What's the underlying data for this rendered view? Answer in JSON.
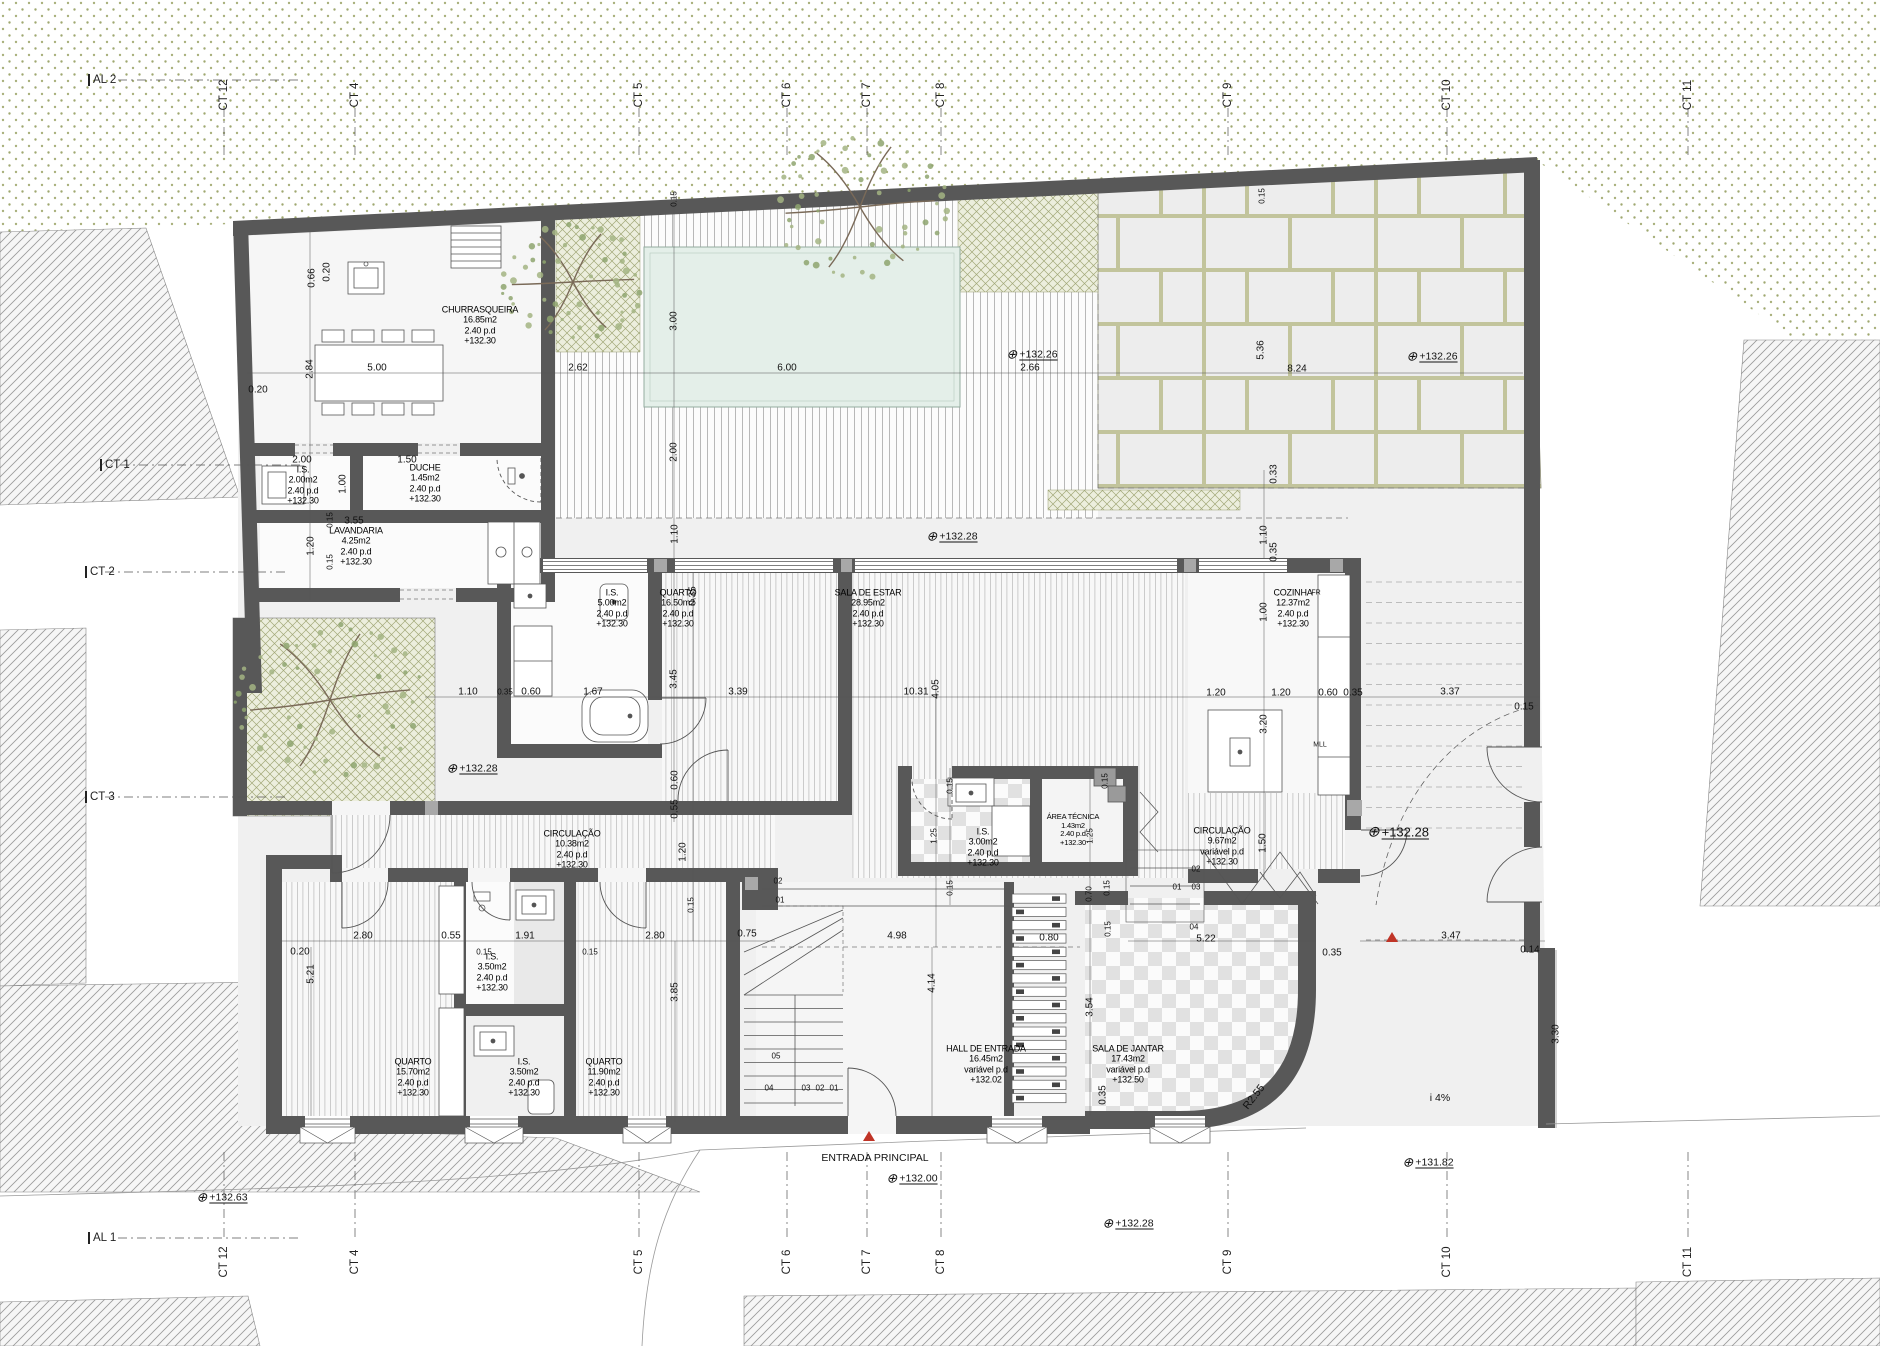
{
  "colors": {
    "wall": "#585858",
    "pool": "#e4efe9",
    "vegetation_dot": "#a9b07c",
    "planter": "#eceedd",
    "slab_joint": "#c2c49c",
    "accent_red": "#c03427"
  },
  "rooms": [
    {
      "name": "CHURRASQUEIRA",
      "area": "16.85m2",
      "pd": "2.40  p.d",
      "level": "+132.30",
      "x": 480,
      "y": 325
    },
    {
      "name": "I.S.",
      "area": "2.00m2",
      "pd": "2.40  p.d",
      "level": "+132.30",
      "x": 303,
      "y": 485
    },
    {
      "name": "DUCHE",
      "area": "1.45m2",
      "pd": "2.40  p.d",
      "level": "+132.30",
      "x": 425,
      "y": 483
    },
    {
      "name": "LAVANDARIA",
      "area": "4.25m2",
      "pd": "2.40  p.d",
      "level": "+132.30",
      "x": 356,
      "y": 546
    },
    {
      "name": "I.S.",
      "area": "5.00m2",
      "pd": "2.40  p.d",
      "level": "+132.30",
      "x": 612,
      "y": 608
    },
    {
      "name": "QUARTO",
      "area": "16.50m2",
      "pd": "2.40  p.d",
      "level": "+132.30",
      "x": 678,
      "y": 608
    },
    {
      "name": "SALA DE ESTAR",
      "area": "28.95m2",
      "pd": "2.40  p.d",
      "level": "+132.30",
      "x": 868,
      "y": 608
    },
    {
      "name": "COZINHA",
      "area": "12.37m2",
      "pd": "2.40  p.d",
      "level": "+132.30",
      "x": 1293,
      "y": 608
    },
    {
      "name": "I.S.",
      "area": "3.00m2",
      "pd": "2.40  p.d",
      "level": "+132.30",
      "x": 983,
      "y": 847
    },
    {
      "name": "ÁREA TÉCNICA",
      "area": "1.43m2",
      "pd": "2.40  p.d",
      "level": "+132.30",
      "x": 1073,
      "y": 830,
      "small": true
    },
    {
      "name": "CIRCULAÇÃO",
      "area": "9.67m2",
      "pd": "variável  p.d",
      "level": "+132.30",
      "x": 1222,
      "y": 846
    },
    {
      "name": "CIRCULAÇÃO",
      "area": "10.38m2",
      "pd": "2.40  p.d",
      "level": "+132.30",
      "x": 572,
      "y": 849
    },
    {
      "name": "HALL  DE  ENTRADA",
      "area": "16.45m2",
      "pd": "variável  p.d",
      "level": "+132.02",
      "x": 986,
      "y": 1064
    },
    {
      "name": "SALA  DE  JANTAR",
      "area": "17.43m2",
      "pd": "variável  p.d",
      "level": "+132.50",
      "x": 1128,
      "y": 1064
    },
    {
      "name": "QUARTO",
      "area": "15.70m2",
      "pd": "2.40  p.d",
      "level": "+132.30",
      "x": 413,
      "y": 1077
    },
    {
      "name": "I.S.",
      "area": "3.50m2",
      "pd": "2.40  p.d",
      "level": "+132.30",
      "x": 524,
      "y": 1077
    },
    {
      "name": "QUARTO",
      "area": "11.90m2",
      "pd": "2.40  p.d",
      "level": "+132.30",
      "x": 604,
      "y": 1077
    },
    {
      "name": "I.S.",
      "area": "3.50m2",
      "pd": "2.40  p.d",
      "level": "+132.30",
      "x": 492,
      "y": 972
    }
  ],
  "dims": [
    {
      "t": "0.66",
      "x": 312,
      "y": 278,
      "r": 1
    },
    {
      "t": "0.20",
      "x": 327,
      "y": 272,
      "r": 1
    },
    {
      "t": "2.84",
      "x": 310,
      "y": 369,
      "r": 1
    },
    {
      "t": "5.00",
      "x": 377,
      "y": 368
    },
    {
      "t": "2.62",
      "x": 578,
      "y": 368
    },
    {
      "t": "6.00",
      "x": 787,
      "y": 368
    },
    {
      "t": "2.66",
      "x": 1030,
      "y": 368
    },
    {
      "t": "8.24",
      "x": 1297,
      "y": 369
    },
    {
      "t": "5.36",
      "x": 1261,
      "y": 350,
      "r": 1
    },
    {
      "t": "3.00",
      "x": 674,
      "y": 321,
      "r": 1
    },
    {
      "t": "2.00",
      "x": 674,
      "y": 452,
      "r": 1
    },
    {
      "t": "0.15",
      "x": 674,
      "y": 199,
      "r": 1,
      "s": 1
    },
    {
      "t": "0.15",
      "x": 1262,
      "y": 196,
      "r": 1,
      "s": 1
    },
    {
      "t": "0.20",
      "x": 258,
      "y": 390
    },
    {
      "t": "2.00",
      "x": 302,
      "y": 460
    },
    {
      "t": "1.50",
      "x": 407,
      "y": 460
    },
    {
      "t": "1.00",
      "x": 343,
      "y": 484,
      "r": 1
    },
    {
      "t": "3.55",
      "x": 354,
      "y": 521
    },
    {
      "t": "0.15",
      "x": 330,
      "y": 520,
      "r": 1,
      "s": 1
    },
    {
      "t": "1.20",
      "x": 311,
      "y": 546,
      "r": 1
    },
    {
      "t": "0.15",
      "x": 330,
      "y": 562,
      "r": 1,
      "s": 1
    },
    {
      "t": "0.33",
      "x": 1274,
      "y": 474,
      "r": 1
    },
    {
      "t": "1.10",
      "x": 1264,
      "y": 535,
      "r": 1
    },
    {
      "t": "0.35",
      "x": 1274,
      "y": 552,
      "r": 1
    },
    {
      "t": "1.00",
      "x": 1264,
      "y": 612,
      "r": 1
    },
    {
      "t": "1.10",
      "x": 675,
      "y": 534,
      "r": 1
    },
    {
      "t": "3.45",
      "x": 674,
      "y": 679,
      "r": 1
    },
    {
      "t": "0.35",
      "x": 693,
      "y": 596,
      "r": 1
    },
    {
      "t": "0.60",
      "x": 675,
      "y": 780,
      "r": 1
    },
    {
      "t": "0.55",
      "x": 675,
      "y": 809,
      "r": 1
    },
    {
      "t": "1.20",
      "x": 683,
      "y": 852,
      "r": 1
    },
    {
      "t": "1.10",
      "x": 468,
      "y": 692
    },
    {
      "t": "0.35",
      "x": 505,
      "y": 692,
      "s": 1
    },
    {
      "t": "0.60",
      "x": 531,
      "y": 692
    },
    {
      "t": "1.67",
      "x": 593,
      "y": 692
    },
    {
      "t": "3.39",
      "x": 738,
      "y": 692
    },
    {
      "t": "10.31",
      "x": 916,
      "y": 692
    },
    {
      "t": "4.05",
      "x": 936,
      "y": 689,
      "r": 1
    },
    {
      "t": "1.20",
      "x": 1216,
      "y": 693
    },
    {
      "t": "1.20",
      "x": 1281,
      "y": 693
    },
    {
      "t": "0.60",
      "x": 1328,
      "y": 693
    },
    {
      "t": "0.35",
      "x": 1353,
      "y": 693
    },
    {
      "t": "3.37",
      "x": 1450,
      "y": 692
    },
    {
      "t": "0.15",
      "x": 1524,
      "y": 707
    },
    {
      "t": "3.20",
      "x": 1264,
      "y": 724,
      "r": 1
    },
    {
      "t": "1.50",
      "x": 1263,
      "y": 843,
      "r": 1
    },
    {
      "t": "0.15",
      "x": 950,
      "y": 786,
      "r": 1,
      "s": 1
    },
    {
      "t": "0.15",
      "x": 1105,
      "y": 781,
      "r": 1,
      "s": 1
    },
    {
      "t": "1.25",
      "x": 934,
      "y": 836,
      "r": 1,
      "s": 1
    },
    {
      "t": "1.25",
      "x": 1090,
      "y": 836,
      "r": 1,
      "s": 1
    },
    {
      "t": "0.15",
      "x": 950,
      "y": 888,
      "r": 1,
      "s": 1
    },
    {
      "t": "0.70",
      "x": 1089,
      "y": 894,
      "r": 1,
      "s": 1
    },
    {
      "t": "0.15",
      "x": 1107,
      "y": 888,
      "r": 1,
      "s": 1
    },
    {
      "t": "4.98",
      "x": 897,
      "y": 936
    },
    {
      "t": "0.80",
      "x": 1049,
      "y": 938
    },
    {
      "t": "0.15",
      "x": 1108,
      "y": 929,
      "r": 1,
      "s": 1
    },
    {
      "t": "4.14",
      "x": 932,
      "y": 983,
      "r": 1
    },
    {
      "t": "3.54",
      "x": 1090,
      "y": 1007,
      "r": 1
    },
    {
      "t": "5.22",
      "x": 1206,
      "y": 939
    },
    {
      "t": "0.35",
      "x": 1332,
      "y": 953
    },
    {
      "t": "0.35",
      "x": 1103,
      "y": 1095,
      "r": 1
    },
    {
      "t": "2.80",
      "x": 363,
      "y": 936
    },
    {
      "t": "0.55",
      "x": 451,
      "y": 936
    },
    {
      "t": "1.91",
      "x": 525,
      "y": 936
    },
    {
      "t": "2.80",
      "x": 655,
      "y": 936
    },
    {
      "t": "0.75",
      "x": 747,
      "y": 934
    },
    {
      "t": "0.20",
      "x": 300,
      "y": 952
    },
    {
      "t": "5.21",
      "x": 311,
      "y": 974,
      "r": 1
    },
    {
      "t": "0.15",
      "x": 484,
      "y": 952,
      "s": 1
    },
    {
      "t": "0.15",
      "x": 590,
      "y": 952,
      "s": 1
    },
    {
      "t": "3.85",
      "x": 675,
      "y": 992,
      "r": 1
    },
    {
      "t": "0.15",
      "x": 691,
      "y": 905,
      "r": 1,
      "s": 1
    },
    {
      "t": "3.47",
      "x": 1451,
      "y": 936
    },
    {
      "t": "0.14",
      "x": 1530,
      "y": 950
    },
    {
      "t": "3.30",
      "x": 1556,
      "y": 1034,
      "r": 1
    }
  ],
  "marks": [
    {
      "t": "02",
      "x": 778,
      "y": 881
    },
    {
      "t": "01",
      "x": 780,
      "y": 900
    },
    {
      "t": "05",
      "x": 776,
      "y": 1056
    },
    {
      "t": "04",
      "x": 769,
      "y": 1088
    },
    {
      "t": "03",
      "x": 806,
      "y": 1088
    },
    {
      "t": "02",
      "x": 820,
      "y": 1088
    },
    {
      "t": "01",
      "x": 834,
      "y": 1088
    },
    {
      "t": "02",
      "x": 1196,
      "y": 869
    },
    {
      "t": "01",
      "x": 1177,
      "y": 887
    },
    {
      "t": "03",
      "x": 1196,
      "y": 887
    },
    {
      "t": "04",
      "x": 1194,
      "y": 927
    }
  ],
  "elevations": [
    {
      "v": "+132.26",
      "x": 1032,
      "y": 354
    },
    {
      "v": "+132.26",
      "x": 1432,
      "y": 356
    },
    {
      "v": "+132.28",
      "x": 952,
      "y": 536
    },
    {
      "v": "+132.28",
      "x": 472,
      "y": 768
    },
    {
      "v": "+132.28",
      "x": 1398,
      "y": 832,
      "b": 1
    },
    {
      "v": "+132.28",
      "x": 1128,
      "y": 1223
    },
    {
      "v": "+132.00",
      "x": 912,
      "y": 1178
    },
    {
      "v": "+132.63",
      "x": 222,
      "y": 1197
    },
    {
      "v": "+131.82",
      "x": 1428,
      "y": 1162
    }
  ],
  "notes": [
    {
      "t": "ENTRADA  PRINCIPAL",
      "x": 875,
      "y": 1158
    },
    {
      "t": "i  4%",
      "x": 1440,
      "y": 1098
    },
    {
      "t": "R2.55",
      "x": 1254,
      "y": 1097,
      "r": -52
    },
    {
      "t": "MLL",
      "x": 1320,
      "y": 745,
      "s": 1
    },
    {
      "t": "FR",
      "x": 1316,
      "y": 593,
      "s": 1
    }
  ],
  "grid": {
    "top_y": 95,
    "bottom_y": 1262,
    "cols": [
      {
        "t": "CT 12",
        "x": 224
      },
      {
        "t": "CT 4",
        "x": 355
      },
      {
        "t": "CT 5",
        "x": 639
      },
      {
        "t": "CT 6",
        "x": 787
      },
      {
        "t": "CT 7",
        "x": 867
      },
      {
        "t": "CT 8",
        "x": 941
      },
      {
        "t": "CT 9",
        "x": 1228
      },
      {
        "t": "CT 10",
        "x": 1447
      },
      {
        "t": "CT 11",
        "x": 1688
      }
    ],
    "left": [
      {
        "t": "CT 1",
        "x": 100,
        "y": 465
      },
      {
        "t": "CT 2",
        "x": 85,
        "y": 572
      },
      {
        "t": "CT 3",
        "x": 85,
        "y": 797
      }
    ],
    "axes": [
      {
        "t": "AL 2",
        "x": 88,
        "y": 80
      },
      {
        "t": "AL 1",
        "x": 88,
        "y": 1238
      }
    ]
  },
  "entrance_markers": [
    {
      "x": 869,
      "y": 1141
    },
    {
      "x": 1392,
      "y": 942
    }
  ]
}
